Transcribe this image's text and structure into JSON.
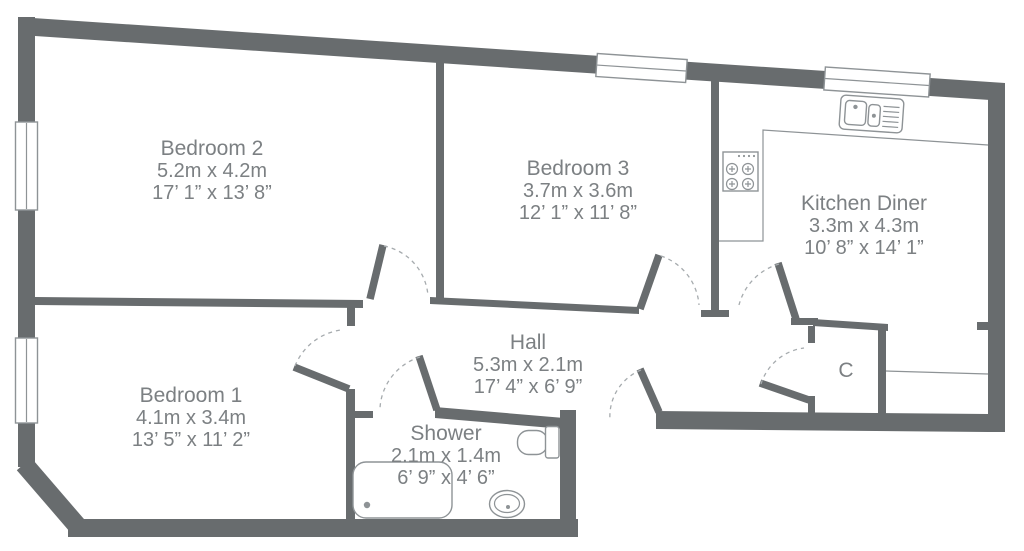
{
  "plan": {
    "rooms": {
      "bedroom2": {
        "name": "Bedroom 2",
        "metric": "5.2m x 4.2m",
        "imperial": "17’ 1” x 13’ 8”"
      },
      "bedroom3": {
        "name": "Bedroom 3",
        "metric": "3.7m x 3.6m",
        "imperial": "12’ 1” x 11’ 8”"
      },
      "kitchen_diner": {
        "name": "Kitchen Diner",
        "metric": "3.3m x 4.3m",
        "imperial": "10’ 8” x 14’ 1”"
      },
      "bedroom1": {
        "name": "Bedroom 1",
        "metric": "4.1m x 3.4m",
        "imperial": "13’ 5” x 11’ 2”"
      },
      "hall": {
        "name": "Hall",
        "metric": "5.3m x 2.1m",
        "imperial": "17’ 4” x 6’ 9”"
      },
      "shower": {
        "name": "Shower",
        "metric": "2.1m x 1.4m",
        "imperial": "6’ 9” x 4’ 6”"
      }
    },
    "cupboard": {
      "label": "C"
    },
    "colors": {
      "wall": "#686c6e",
      "text": "#7c8083",
      "fixture": "#8e9396",
      "arc": "#a6abae"
    }
  }
}
